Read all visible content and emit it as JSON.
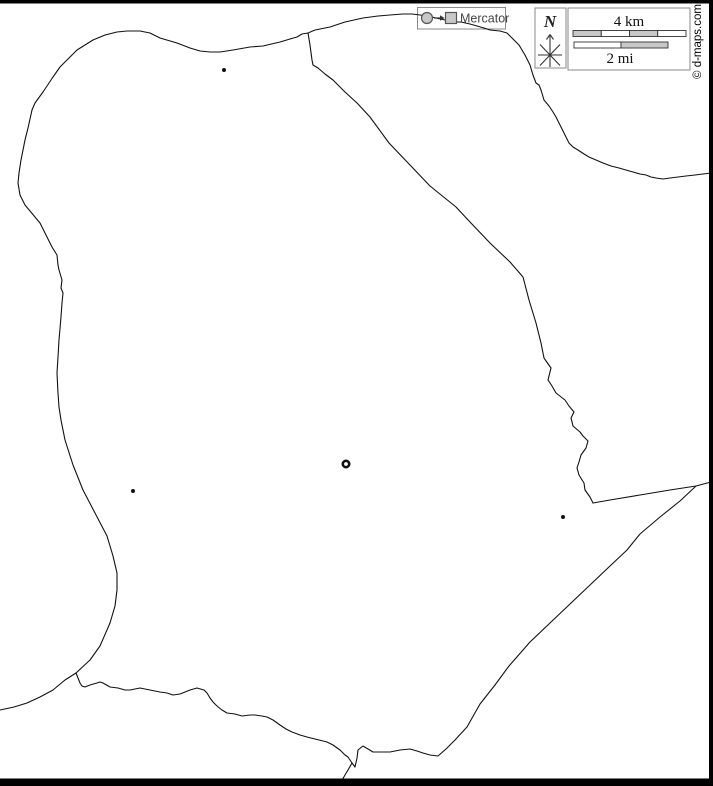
{
  "frame": {
    "copyright": "© d-maps.com"
  },
  "legend": {
    "projection": {
      "label": "Mercator"
    },
    "compass": {
      "label": "N"
    },
    "scale": {
      "top_label": "4 km",
      "bottom_label": "2 mi"
    }
  },
  "colors": {
    "line": "#111111",
    "box_border": "#8a8a8a",
    "glyph_fill": "#c8c8c8",
    "glyph_stroke": "#555555",
    "bar_gray": "#c8c8c8",
    "bar_white": "#ffffff",
    "bar_stroke": "#333333",
    "frame_black": "#000000",
    "label_gray": "#444444"
  },
  "map": {
    "stroke": "#111111",
    "background": "#ffffff",
    "paths": {
      "coastline_west_north_east": [
        [
          76,
          673
        ],
        [
          90,
          660
        ],
        [
          100,
          646
        ],
        [
          110,
          623
        ],
        [
          115,
          606
        ],
        [
          117,
          590
        ],
        [
          117,
          573
        ],
        [
          113,
          556
        ],
        [
          107,
          536
        ],
        [
          95,
          513
        ],
        [
          83,
          490
        ],
        [
          73,
          465
        ],
        [
          65,
          440
        ],
        [
          61,
          420
        ],
        [
          59,
          407
        ],
        [
          58,
          393
        ],
        [
          57,
          373
        ],
        [
          58,
          357
        ],
        [
          59,
          340
        ],
        [
          61,
          317
        ],
        [
          62,
          303
        ],
        [
          63,
          293
        ],
        [
          61,
          288
        ],
        [
          62,
          280
        ],
        [
          59,
          270
        ],
        [
          58,
          265
        ],
        [
          57,
          255
        ],
        [
          52,
          247
        ],
        [
          47,
          237
        ],
        [
          40,
          223
        ],
        [
          35,
          217
        ],
        [
          25,
          205
        ],
        [
          20,
          195
        ],
        [
          18,
          183
        ],
        [
          19,
          173
        ],
        [
          21,
          160
        ],
        [
          25,
          140
        ],
        [
          28,
          128
        ],
        [
          32,
          110
        ],
        [
          35,
          103
        ],
        [
          43,
          92
        ],
        [
          53,
          77
        ],
        [
          60,
          67
        ],
        [
          70,
          57
        ],
        [
          77,
          50
        ],
        [
          93,
          40
        ],
        [
          105,
          35
        ],
        [
          117,
          32
        ],
        [
          127,
          31
        ],
        [
          140,
          31
        ],
        [
          150,
          33
        ],
        [
          160,
          38
        ],
        [
          177,
          43
        ],
        [
          190,
          48
        ],
        [
          200,
          51
        ],
        [
          210,
          52
        ],
        [
          220,
          52
        ],
        [
          233,
          50
        ],
        [
          250,
          47
        ],
        [
          263,
          46
        ],
        [
          280,
          42
        ],
        [
          290,
          39
        ],
        [
          297,
          37
        ],
        [
          302,
          34
        ],
        [
          308,
          33
        ],
        [
          315,
          30
        ],
        [
          330,
          27
        ],
        [
          345,
          22
        ],
        [
          363,
          18
        ],
        [
          378,
          16
        ],
        [
          390,
          15
        ],
        [
          403,
          14
        ],
        [
          412,
          14
        ],
        [
          420,
          15
        ],
        [
          428,
          16
        ],
        [
          436,
          18
        ],
        [
          445,
          20
        ],
        [
          455,
          22
        ],
        [
          461,
          22
        ],
        [
          470,
          24
        ],
        [
          477,
          26
        ],
        [
          484,
          28
        ],
        [
          490,
          30
        ],
        [
          500,
          31
        ],
        [
          507,
          33
        ],
        [
          513,
          39
        ],
        [
          519,
          45
        ],
        [
          525,
          55
        ],
        [
          530,
          65
        ],
        [
          533,
          75
        ],
        [
          536,
          83
        ],
        [
          539,
          85
        ],
        [
          541,
          90
        ],
        [
          544,
          100
        ],
        [
          549,
          106
        ],
        [
          553,
          112
        ],
        [
          556,
          117
        ],
        [
          559,
          123
        ],
        [
          563,
          131
        ],
        [
          569,
          143
        ],
        [
          573,
          147
        ],
        [
          578,
          150
        ],
        [
          584,
          154
        ],
        [
          589,
          157
        ],
        [
          596,
          160
        ],
        [
          603,
          163
        ],
        [
          611,
          166
        ],
        [
          619,
          168
        ],
        [
          626,
          170
        ],
        [
          633,
          172
        ],
        [
          640,
          174
        ],
        [
          646,
          175
        ],
        [
          651,
          177
        ],
        [
          656,
          178
        ],
        [
          663,
          179
        ],
        [
          670,
          178
        ],
        [
          678,
          177
        ],
        [
          686,
          176
        ],
        [
          695,
          175
        ],
        [
          703,
          174
        ],
        [
          711,
          173
        ]
      ],
      "border_northeast": [
        [
          308,
          33
        ],
        [
          310,
          45
        ],
        [
          312,
          60
        ],
        [
          313,
          65
        ],
        [
          318,
          68
        ],
        [
          325,
          74
        ],
        [
          333,
          80
        ],
        [
          345,
          92
        ],
        [
          357,
          103
        ],
        [
          370,
          117
        ],
        [
          389,
          143
        ],
        [
          410,
          165
        ],
        [
          430,
          186
        ],
        [
          456,
          207
        ],
        [
          470,
          222
        ],
        [
          490,
          243
        ],
        [
          510,
          262
        ],
        [
          523,
          277
        ],
        [
          529,
          300
        ],
        [
          536,
          323
        ],
        [
          541,
          343
        ],
        [
          544,
          358
        ],
        [
          551,
          368
        ],
        [
          548,
          380
        ],
        [
          552,
          386
        ],
        [
          556,
          393
        ],
        [
          565,
          400
        ],
        [
          569,
          406
        ],
        [
          574,
          412
        ],
        [
          571,
          418
        ],
        [
          573,
          426
        ],
        [
          580,
          432
        ],
        [
          583,
          436
        ],
        [
          588,
          441
        ],
        [
          586,
          448
        ],
        [
          581,
          455
        ],
        [
          579,
          462
        ],
        [
          577,
          468
        ],
        [
          579,
          475
        ],
        [
          584,
          483
        ],
        [
          585,
          490
        ],
        [
          590,
          497
        ],
        [
          593,
          503
        ]
      ],
      "border_east": [
        [
          593,
          503
        ],
        [
          610,
          500
        ],
        [
          640,
          495
        ],
        [
          670,
          490
        ],
        [
          696,
          486
        ],
        [
          711,
          482
        ]
      ],
      "border_southeast": [
        [
          696,
          486
        ],
        [
          680,
          501
        ],
        [
          660,
          517
        ],
        [
          640,
          534
        ],
        [
          627,
          550
        ],
        [
          610,
          566
        ],
        [
          590,
          585
        ],
        [
          570,
          604
        ],
        [
          550,
          623
        ],
        [
          530,
          642
        ],
        [
          509,
          666
        ],
        [
          495,
          685
        ],
        [
          480,
          704
        ],
        [
          467,
          727
        ],
        [
          455,
          740
        ],
        [
          446,
          749
        ],
        [
          438,
          756
        ]
      ],
      "border_south": [
        [
          76,
          673
        ],
        [
          78,
          678
        ],
        [
          80,
          683
        ],
        [
          82,
          686
        ],
        [
          85,
          687
        ],
        [
          90,
          685
        ],
        [
          97,
          683
        ],
        [
          100,
          682
        ],
        [
          103,
          683
        ],
        [
          110,
          687
        ],
        [
          118,
          688
        ],
        [
          125,
          690
        ],
        [
          130,
          690
        ],
        [
          140,
          688
        ],
        [
          150,
          690
        ],
        [
          160,
          692
        ],
        [
          167,
          693
        ],
        [
          173,
          695
        ],
        [
          180,
          694
        ],
        [
          190,
          690
        ],
        [
          197,
          688
        ],
        [
          204,
          690
        ],
        [
          207,
          693
        ],
        [
          210,
          698
        ],
        [
          213,
          702
        ],
        [
          217,
          706
        ],
        [
          222,
          710
        ],
        [
          227,
          713
        ],
        [
          235,
          714
        ],
        [
          242,
          716
        ],
        [
          250,
          715
        ],
        [
          255,
          715
        ],
        [
          262,
          716
        ],
        [
          267,
          717
        ],
        [
          273,
          720
        ],
        [
          280,
          725
        ],
        [
          286,
          729
        ],
        [
          292,
          732
        ],
        [
          300,
          735
        ],
        [
          307,
          737
        ],
        [
          315,
          739
        ],
        [
          323,
          741
        ],
        [
          327,
          742
        ],
        [
          333,
          745
        ],
        [
          340,
          750
        ],
        [
          345,
          755
        ],
        [
          348,
          757
        ],
        [
          352,
          763
        ],
        [
          355,
          767
        ],
        [
          357,
          758
        ],
        [
          358,
          750
        ],
        [
          363,
          746
        ],
        [
          368,
          749
        ],
        [
          373,
          752
        ],
        [
          380,
          752
        ],
        [
          390,
          752
        ],
        [
          400,
          750
        ],
        [
          410,
          749
        ],
        [
          417,
          751
        ],
        [
          423,
          753
        ],
        [
          430,
          755
        ],
        [
          438,
          756
        ]
      ],
      "border_southwest_exit": [
        [
          76,
          673
        ],
        [
          65,
          680
        ],
        [
          53,
          690
        ],
        [
          40,
          697
        ],
        [
          27,
          703
        ],
        [
          14,
          707
        ],
        [
          0,
          710
        ]
      ],
      "border_bottom_exit": [
        [
          352,
          763
        ],
        [
          348,
          770
        ],
        [
          345,
          775
        ],
        [
          341,
          782
        ]
      ]
    },
    "markers": {
      "towns": [
        [
          224,
          70
        ],
        [
          133,
          491
        ],
        [
          563,
          517
        ]
      ],
      "capital": {
        "x": 346,
        "y": 464
      }
    }
  }
}
